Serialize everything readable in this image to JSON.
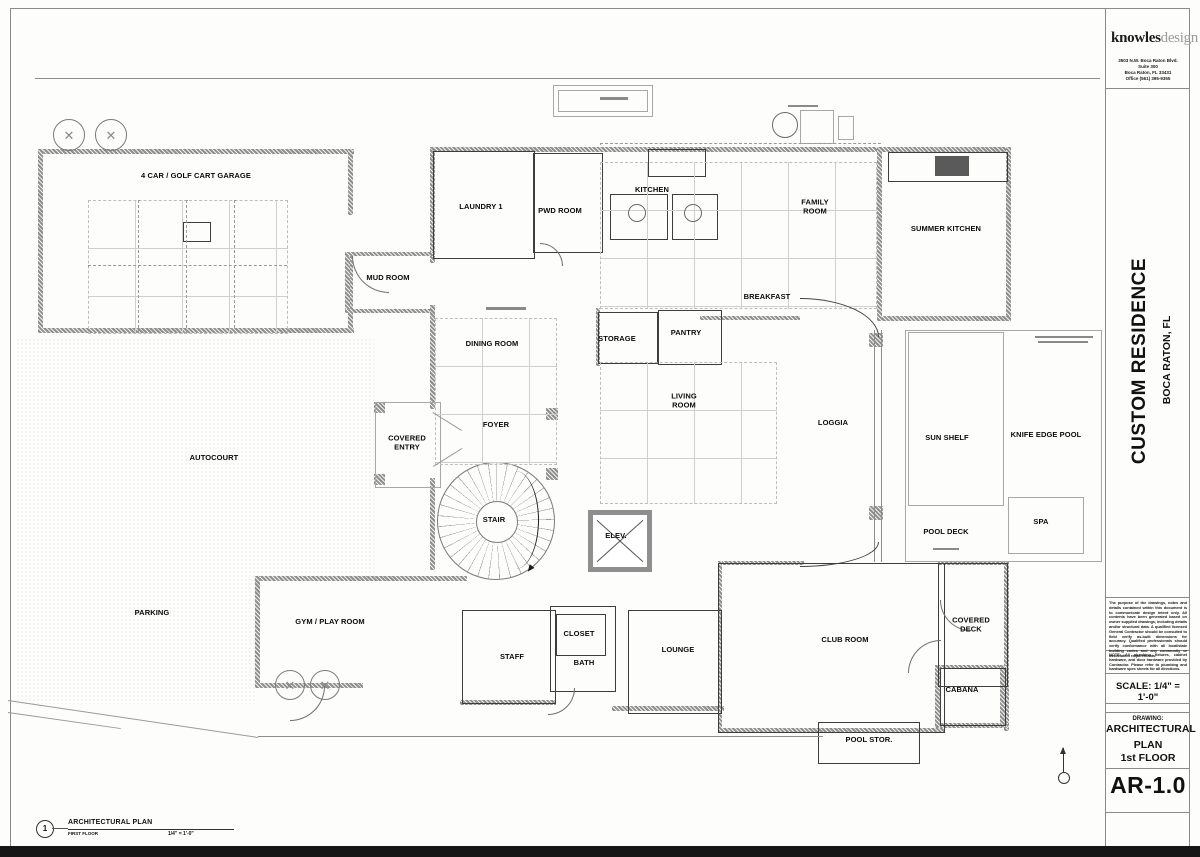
{
  "sheet": {
    "firm_name_bold": "knowles",
    "firm_name_light": "design",
    "firm_address_lines": [
      "3503 N.W. Boca Raton Blvd.",
      "Suite 300",
      "Boca Raton, FL 33431",
      "Office (561) 395-9355"
    ],
    "project_title": "CUSTOM RESIDENCE",
    "project_location": "BOCA RATON, FL",
    "disclaimer": "The purpose of the drawings, notes and details contained within this document is to communicate design intent only. All contents have been generated based on owner supplied drawings, including details and/or structural data. A qualified licensed General Contractor should be consulted to field verify as-built dimensions for accuracy. Qualified professionals should verify conformance with all local/state building codes and any community or association requirements.",
    "note": "NOTE: All plumbing fixtures, cabinet hardware, and door hardware provided by Contractor. Please refer to plumbing and hardware spec sheets for all directions.",
    "scale": "SCALE: 1/4\" = 1'-0\"",
    "drawing_label": "DRAWING:",
    "drawing_title_lines": [
      "ARCHITECTURAL",
      "PLAN",
      "1st FLOOR"
    ],
    "sheet_number": "AR-1.0"
  },
  "footer": {
    "detail_number": "1",
    "title": "ARCHITECTURAL PLAN",
    "subtitle": "FIRST FLOOR",
    "scale": "1/4\" = 1'-0\""
  },
  "rooms": [
    {
      "label": "4 CAR / GOLF CART GARAGE",
      "x": 196,
      "y": 176
    },
    {
      "label": "LAUNDRY 1",
      "x": 481,
      "y": 207
    },
    {
      "label": "PWD ROOM",
      "x": 560,
      "y": 211
    },
    {
      "label": "KITCHEN",
      "x": 652,
      "y": 190
    },
    {
      "label": "FAMILY\nROOM",
      "x": 815,
      "y": 207
    },
    {
      "label": "SUMMER KITCHEN",
      "x": 946,
      "y": 229
    },
    {
      "label": "MUD ROOM",
      "x": 388,
      "y": 278
    },
    {
      "label": "BREAKFAST",
      "x": 767,
      "y": 297
    },
    {
      "label": "DINING ROOM",
      "x": 492,
      "y": 344
    },
    {
      "label": "STORAGE",
      "x": 617,
      "y": 339
    },
    {
      "label": "PANTRY",
      "x": 686,
      "y": 333
    },
    {
      "label": "LIVING\nROOM",
      "x": 684,
      "y": 401
    },
    {
      "label": "LOGGIA",
      "x": 833,
      "y": 423
    },
    {
      "label": "COVERED\nENTRY",
      "x": 407,
      "y": 443
    },
    {
      "label": "FOYER",
      "x": 496,
      "y": 425
    },
    {
      "label": "AUTOCOURT",
      "x": 214,
      "y": 458
    },
    {
      "label": "SUN SHELF",
      "x": 947,
      "y": 438
    },
    {
      "label": "KNIFE EDGE POOL",
      "x": 1046,
      "y": 435
    },
    {
      "label": "STAIR",
      "x": 494,
      "y": 520
    },
    {
      "label": "POOL DECK",
      "x": 946,
      "y": 532
    },
    {
      "label": "SPA",
      "x": 1041,
      "y": 522
    },
    {
      "label": "ELEV.",
      "x": 616,
      "y": 536
    },
    {
      "label": "PARKING",
      "x": 152,
      "y": 613
    },
    {
      "label": "GYM / PLAY ROOM",
      "x": 330,
      "y": 622
    },
    {
      "label": "STAFF",
      "x": 512,
      "y": 657
    },
    {
      "label": "CLOSET",
      "x": 579,
      "y": 634
    },
    {
      "label": "BATH",
      "x": 584,
      "y": 663
    },
    {
      "label": "LOUNGE",
      "x": 678,
      "y": 650
    },
    {
      "label": "CLUB ROOM",
      "x": 845,
      "y": 640
    },
    {
      "label": "COVERED\nDECK",
      "x": 971,
      "y": 625
    },
    {
      "label": "CABANA",
      "x": 962,
      "y": 690
    },
    {
      "label": "POOL STOR.",
      "x": 869,
      "y": 740
    }
  ]
}
